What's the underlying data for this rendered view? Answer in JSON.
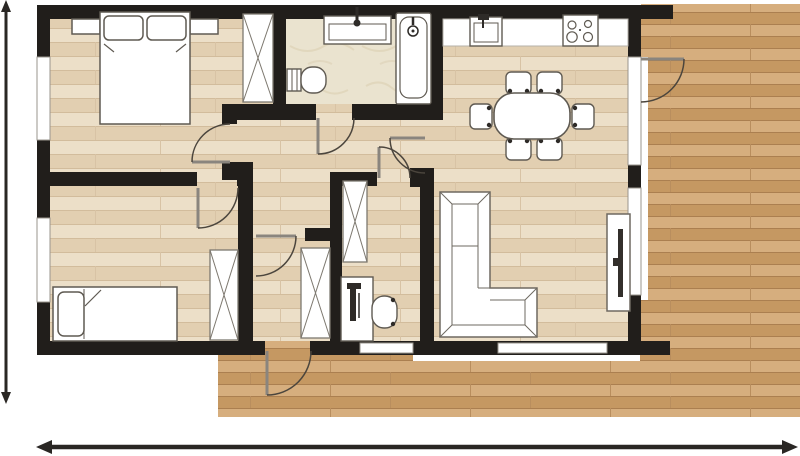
{
  "plan": {
    "label": "Apartment floor plan (top view)",
    "rooms": {
      "master_bedroom": {
        "label": "Master bedroom",
        "furniture": [
          "double-bed",
          "pillow",
          "pillow",
          "nightstand",
          "nightstand",
          "wardrobe"
        ]
      },
      "second_bedroom": {
        "label": "Second bedroom",
        "furniture": [
          "single-bed",
          "pillow",
          "wardrobe"
        ]
      },
      "bathroom": {
        "label": "Bathroom",
        "fixtures": [
          "washbasin",
          "bathtub",
          "toilet"
        ]
      },
      "kitchen_dining": {
        "label": "Kitchen and dining area",
        "furniture": [
          "kitchen-counter",
          "kitchen-sink",
          "cooktop-4-burners",
          "dining-table",
          "chair",
          "chair",
          "chair",
          "chair",
          "chair",
          "chair"
        ]
      },
      "living_room": {
        "label": "Living room",
        "furniture": [
          "corner-sofa",
          "tv-unit",
          "tv"
        ]
      },
      "hallway": {
        "label": "Entry hallway",
        "furniture": [
          "wardrobe",
          "wardrobe"
        ]
      },
      "study_nook": {
        "label": "Study nook",
        "furniture": [
          "desk",
          "desk-chair",
          "storage-closet"
        ]
      },
      "balcony": {
        "label": "Balcony terrace with wood decking"
      }
    },
    "door_count": 8,
    "window_count": 6,
    "doors": [
      "entry-door",
      "master-bedroom-door",
      "second-bedroom-door",
      "bathroom-door",
      "study-door",
      "hall-door",
      "living-room-door",
      "balcony-door"
    ],
    "dimension_lines": {
      "left": {
        "label": "vertical overall dimension line",
        "orientation": "vertical"
      },
      "bottom": {
        "label": "horizontal overall dimension line",
        "orientation": "horizontal"
      }
    },
    "colors": {
      "wall": "#211e1b",
      "interior_floor": "#e8d8be",
      "interior_floor_dark": "#e2cfb1",
      "interior_floor_light": "#ecdfc8",
      "deck_floor": "#cda372",
      "deck_floor_dark": "#c59862",
      "deck_floor_light": "#d6ae7e",
      "bathroom_floor": "#eae3cf",
      "furniture_fill": "#ffffff",
      "furniture_outline": "#5f5a52",
      "door_arc": "#4b453d",
      "dimension_line": "#2a2724",
      "window_fill": "#ffffff",
      "window_edge": "#9a958e"
    }
  }
}
